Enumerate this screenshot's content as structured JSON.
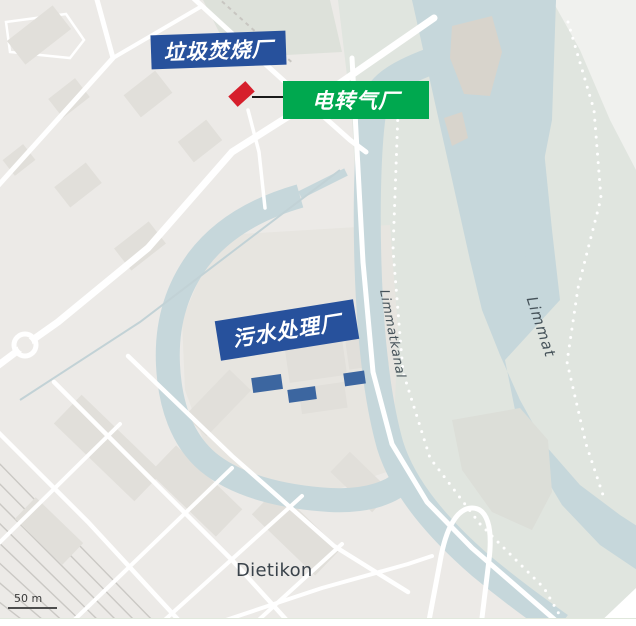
{
  "annotations": {
    "incineration": {
      "label": "垃圾焚烧厂"
    },
    "power_to_gas": {
      "label": "电转气厂"
    },
    "sewage": {
      "label": "污水处理厂"
    }
  },
  "map_labels": {
    "city": "Dietikon",
    "canal": "Limmatkanal",
    "river": "Limmat"
  },
  "scale_bar": {
    "label": "50 m"
  },
  "colors": {
    "annotation_blue": "#27519c",
    "annotation_green": "#00a84f",
    "marker_red": "#d61f2c",
    "water": "#c6d7db",
    "land": "#eceae7",
    "green_bank": "#e0e5df",
    "building": "#e1dfda",
    "water_label": "#46535a",
    "city_label": "#39424a",
    "scale_label": "#3a3a3a"
  }
}
